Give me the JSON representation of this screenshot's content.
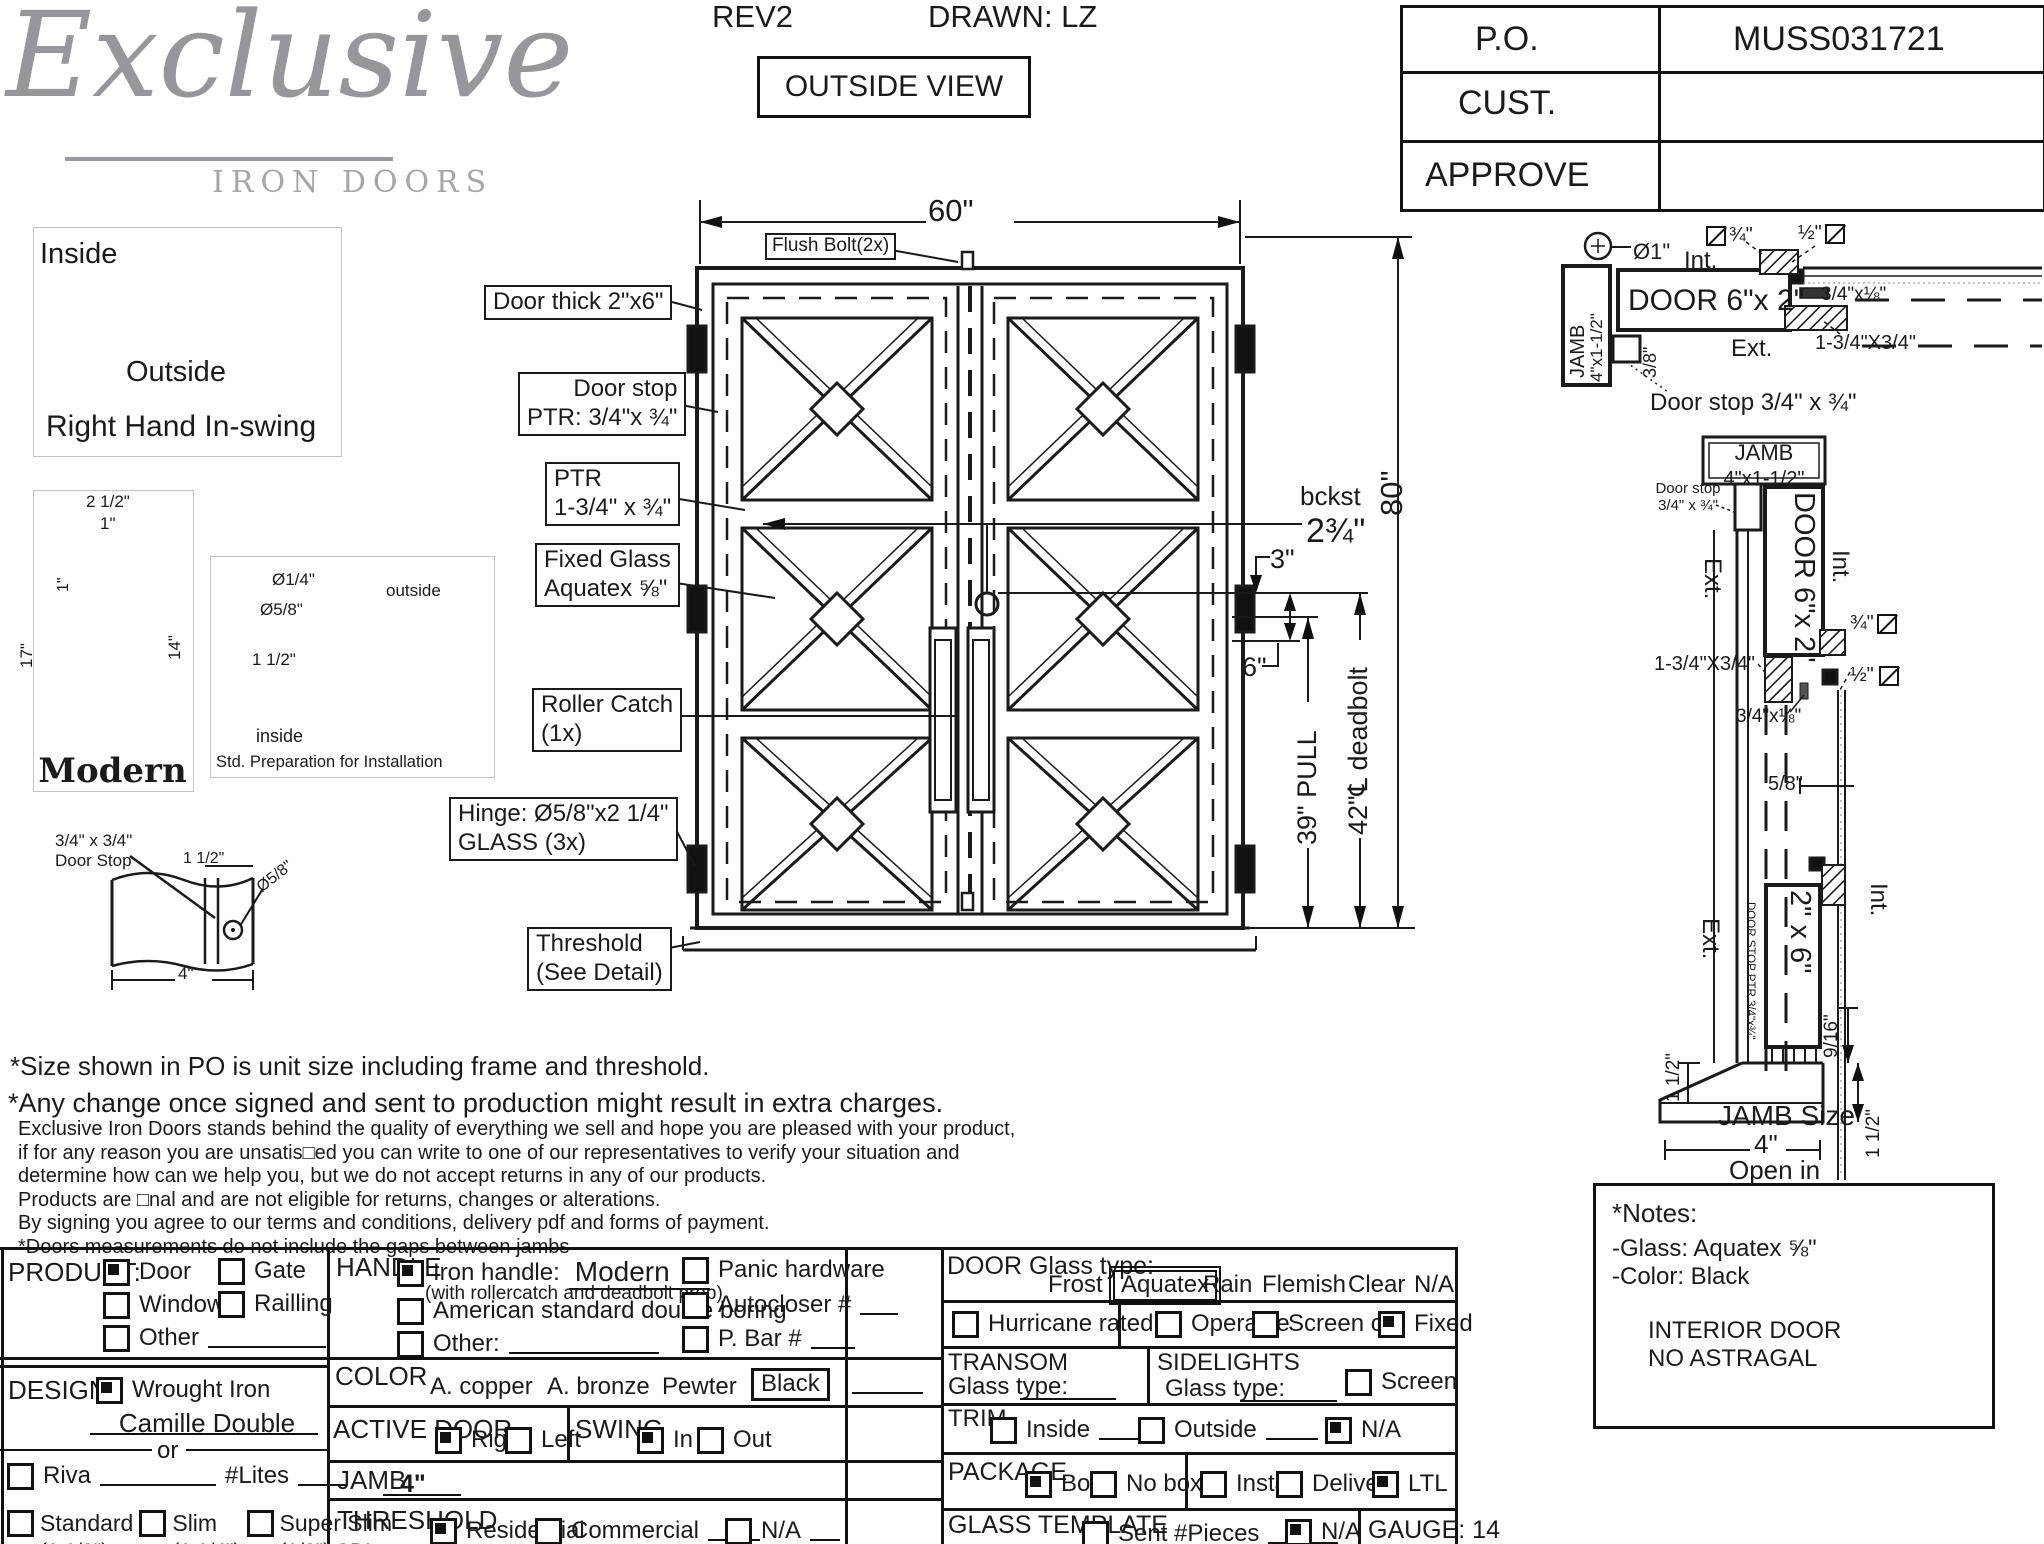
{
  "header": {
    "logo_script": "Exclusive",
    "logo_sub": "IRON DOORS",
    "rev": "REV2",
    "drawn": "DRAWN: LZ",
    "view_label": "OUTSIDE VIEW",
    "po": {
      "po_label": "P.O.",
      "po_value": "MUSS031721",
      "cust_label": "CUST.",
      "cust_value": "",
      "approve_label": "APPROVE",
      "approve_value": ""
    }
  },
  "swing_box": {
    "inside": "Inside",
    "outside": "Outside",
    "caption": "Right Hand In-swing"
  },
  "handle_box": {
    "dim_2_5": "2 1/2\"",
    "dim_1a": "1\"",
    "dim_1b": "1\"",
    "dim_17": "17\"",
    "dim_14": "14\"",
    "caption": "Modern"
  },
  "std_prep": {
    "dia_quarter": "Ø1/4\"",
    "dia_58": "Ø5/8\"",
    "dim_15": "1 1/2\"",
    "outside": "outside",
    "inside": "inside",
    "caption": "Std. Preparation for Installation"
  },
  "doorstop_detail": {
    "size": "3/4\" x 3/4\"",
    "name": "Door Stop",
    "dim_15": "1 1/2\"",
    "dia": "Ø5/8\"",
    "width": "4\""
  },
  "door": {
    "width_dim": "60\"",
    "height_dim": "80\"",
    "flush_bolt": "Flush Bolt(2x)",
    "labels": {
      "thick": "Door thick 2\"x6\"",
      "stop": "Door stop\nPTR: 3/4\"x ¾\"",
      "ptr": "PTR\n1-3/4\" x ¾\"",
      "glass": "Fixed Glass\nAquatex ⅝\"",
      "roller": "Roller Catch\n(1x)",
      "hinge": "Hinge: Ø5/8\"x2 1/4\"\nGLASS (3x)",
      "threshold": "Threshold\n(See Detail)"
    },
    "dims": {
      "bckst": "bckst",
      "backset_val": "2¾\"",
      "three": "3\"",
      "six": "6\"",
      "pull": "39\" PULL",
      "deadbolt": "42\"℄ deadbolt"
    }
  },
  "jamb_head": {
    "dia1": "Ø1\"",
    "int": "Int.",
    "sq34": "¾\"",
    "sq12": "½\"",
    "jamb_v": "JAMB",
    "jamb_size_v": "4\"x1-1/2\"",
    "door_label": "DOOR 6\"x 2\"",
    "strip": "3/4\"x⅛\"",
    "ext": "Ext.",
    "bar": "1-3/4\"X3/4\"",
    "dim38": "3/8\"",
    "door_stop": "Door stop 3/4\" x ¾\""
  },
  "jamb_side": {
    "jamb_title": "JAMB",
    "jamb_size": "4\"x1-1/2\"",
    "door_stop": "Door stop\n3/4\" x ¾\"",
    "ext_top": "Ext.",
    "door_label": "DOOR 6\"x 2\"",
    "int_top": "Int.",
    "sq34": "¾\"",
    "sq12": "½\"",
    "bar": "1-3/4\"X3/4\"",
    "strip": "3/4\"x⅛\"",
    "dim58": "5/8\"",
    "door2": "2\" x 6\"",
    "ext_bot": "Ext.",
    "int_bot": "Int.",
    "stop_ptr": "DOOR STOP PTR 3/4\"x¾\"",
    "dim916": "9/16\"",
    "dim112_left": "1 1/2\"",
    "dim112_right": "1 1/2\"",
    "jamb_size_label": "JAMB Size",
    "jamb_size_val": "4\"",
    "open_in": "Open in"
  },
  "notes_box": {
    "title": "*Notes:",
    "glass": "-Glass: Aquatex ⅝\"",
    "color": "-Color: Black",
    "line3": "INTERIOR DOOR",
    "line4": "NO ASTRAGAL"
  },
  "disclaimer": {
    "line1": "*Size shown in PO is unit size including frame and threshold.",
    "line2": "*Any change once signed and sent to production might result in extra charges.",
    "body": [
      "Exclusive Iron Doors stands behind the quality of everything we sell and hope you are pleased with your product,",
      "if for any reason you are unsatis□ed you can write to one of our representatives to verify your situation and",
      "determine how can we help you, but we do not accept returns in any of our products.",
      "Products are □nal and are not eligible for returns, changes or alterations.",
      "By signing you agree to our terms and conditions, delivery pdf and forms of payment.",
      "*Doors measurements do not include the gaps between jambs"
    ]
  },
  "form": {
    "product": {
      "title": "PRODUCT:",
      "door": {
        "label": "Door",
        "cls": "cb on"
      },
      "gate": {
        "label": "Gate",
        "cls": "cb"
      },
      "window": {
        "label": "Window",
        "cls": "cb"
      },
      "railing": {
        "label": "Railling",
        "cls": "cb"
      },
      "other": {
        "label": "Other",
        "cls": "cb"
      }
    },
    "design": {
      "title": "DESIGN:",
      "wrought": {
        "label": "Wrought Iron",
        "cls": "cb on"
      },
      "model": "Camille Double",
      "or_text": "or",
      "riva": {
        "label": "Riva",
        "cls": "cb"
      },
      "lites": "#Lites",
      "standard": {
        "label": "Standard",
        "sub": "(1 1/2\")",
        "cls": "cb"
      },
      "slim": {
        "label": "Slim",
        "sub": "(1 1/4\")",
        "cls": "cb"
      },
      "superslim": {
        "label": "Super Slim",
        "sub": "(1/2\") SDL",
        "cls": "cb"
      }
    },
    "handle": {
      "title": "HANDLE",
      "iron": {
        "label": "Iron handle:",
        "value": "Modern",
        "note": "(with rollercatch and deadbolt prep)",
        "cls": "cb on"
      },
      "american": {
        "label": "American standard double boring",
        "cls": "cb"
      },
      "other": {
        "label": "Other:",
        "cls": "cb"
      },
      "panic": {
        "label": "Panic hardware",
        "cls": "cb"
      },
      "autocloser": {
        "label": "Autocloser #",
        "cls": "cb"
      },
      "pbar": {
        "label": "P. Bar #",
        "cls": "cb"
      }
    },
    "color": {
      "title": "COLOR",
      "copper": "A. copper",
      "bronze": "A. bronze",
      "pewter": "Pewter",
      "black": "Black"
    },
    "active_door": {
      "title": "ACTIVE DOOR",
      "right": {
        "label": "Right",
        "cls": "cb on"
      },
      "left": {
        "label": "Left",
        "cls": "cb"
      }
    },
    "swing": {
      "title": "SWING",
      "in": {
        "label": "In",
        "cls": "cb on"
      },
      "out": {
        "label": "Out",
        "cls": "cb"
      }
    },
    "jamb": {
      "title": "JAMB:",
      "value": "4\""
    },
    "threshold": {
      "title": "THRESHOLD",
      "residential": {
        "label": "Residential",
        "cls": "cb on"
      },
      "commercial": {
        "label": "Commercial",
        "cls": "cb"
      },
      "na": {
        "label": "N/A",
        "cls": "cb"
      }
    },
    "door_glass": {
      "title": "DOOR Glass type:",
      "frost": "Frost",
      "aquatex": "Aquatex",
      "rain": "Rain",
      "flemish": "Flemish",
      "clear": "Clear",
      "na": "N/A"
    },
    "glass_opts": {
      "hurricane": {
        "label": "Hurricane rated",
        "cls": "cb"
      },
      "operable": {
        "label": "Operable",
        "cls": "cb"
      },
      "screen_or": {
        "label": "Screen or",
        "cls": "cb"
      },
      "fixed": {
        "label": "Fixed",
        "cls": "cb on"
      }
    },
    "transom": {
      "title": "TRANSOM",
      "glass_label": "Glass type:"
    },
    "sidelights": {
      "title": "SIDELIGHTS",
      "glass_label": "Glass type:",
      "screen": {
        "label": "Screen",
        "cls": "cb"
      }
    },
    "trim": {
      "title": "TRIM",
      "inside": {
        "label": "Inside",
        "cls": "cb"
      },
      "outside": {
        "label": "Outside",
        "cls": "cb"
      },
      "na": {
        "label": "N/A",
        "cls": "cb on"
      }
    },
    "package": {
      "title": "PACKAGE",
      "box": {
        "label": "Box",
        "cls": "cb on"
      },
      "nobox": {
        "label": "No box",
        "cls": "cb"
      },
      "install": {
        "label": "Install",
        "cls": "cb"
      },
      "delivery": {
        "label": "Delivery",
        "cls": "cb"
      },
      "ltl": {
        "label": "LTL",
        "cls": "cb on"
      }
    },
    "glass_template": {
      "title": "GLASS TEMPLATE",
      "sent": {
        "label": "Sent #Pieces",
        "cls": "cb"
      },
      "na": {
        "label": "N/A",
        "cls": "cb on"
      }
    },
    "gauge": "GAUGE: 14"
  }
}
